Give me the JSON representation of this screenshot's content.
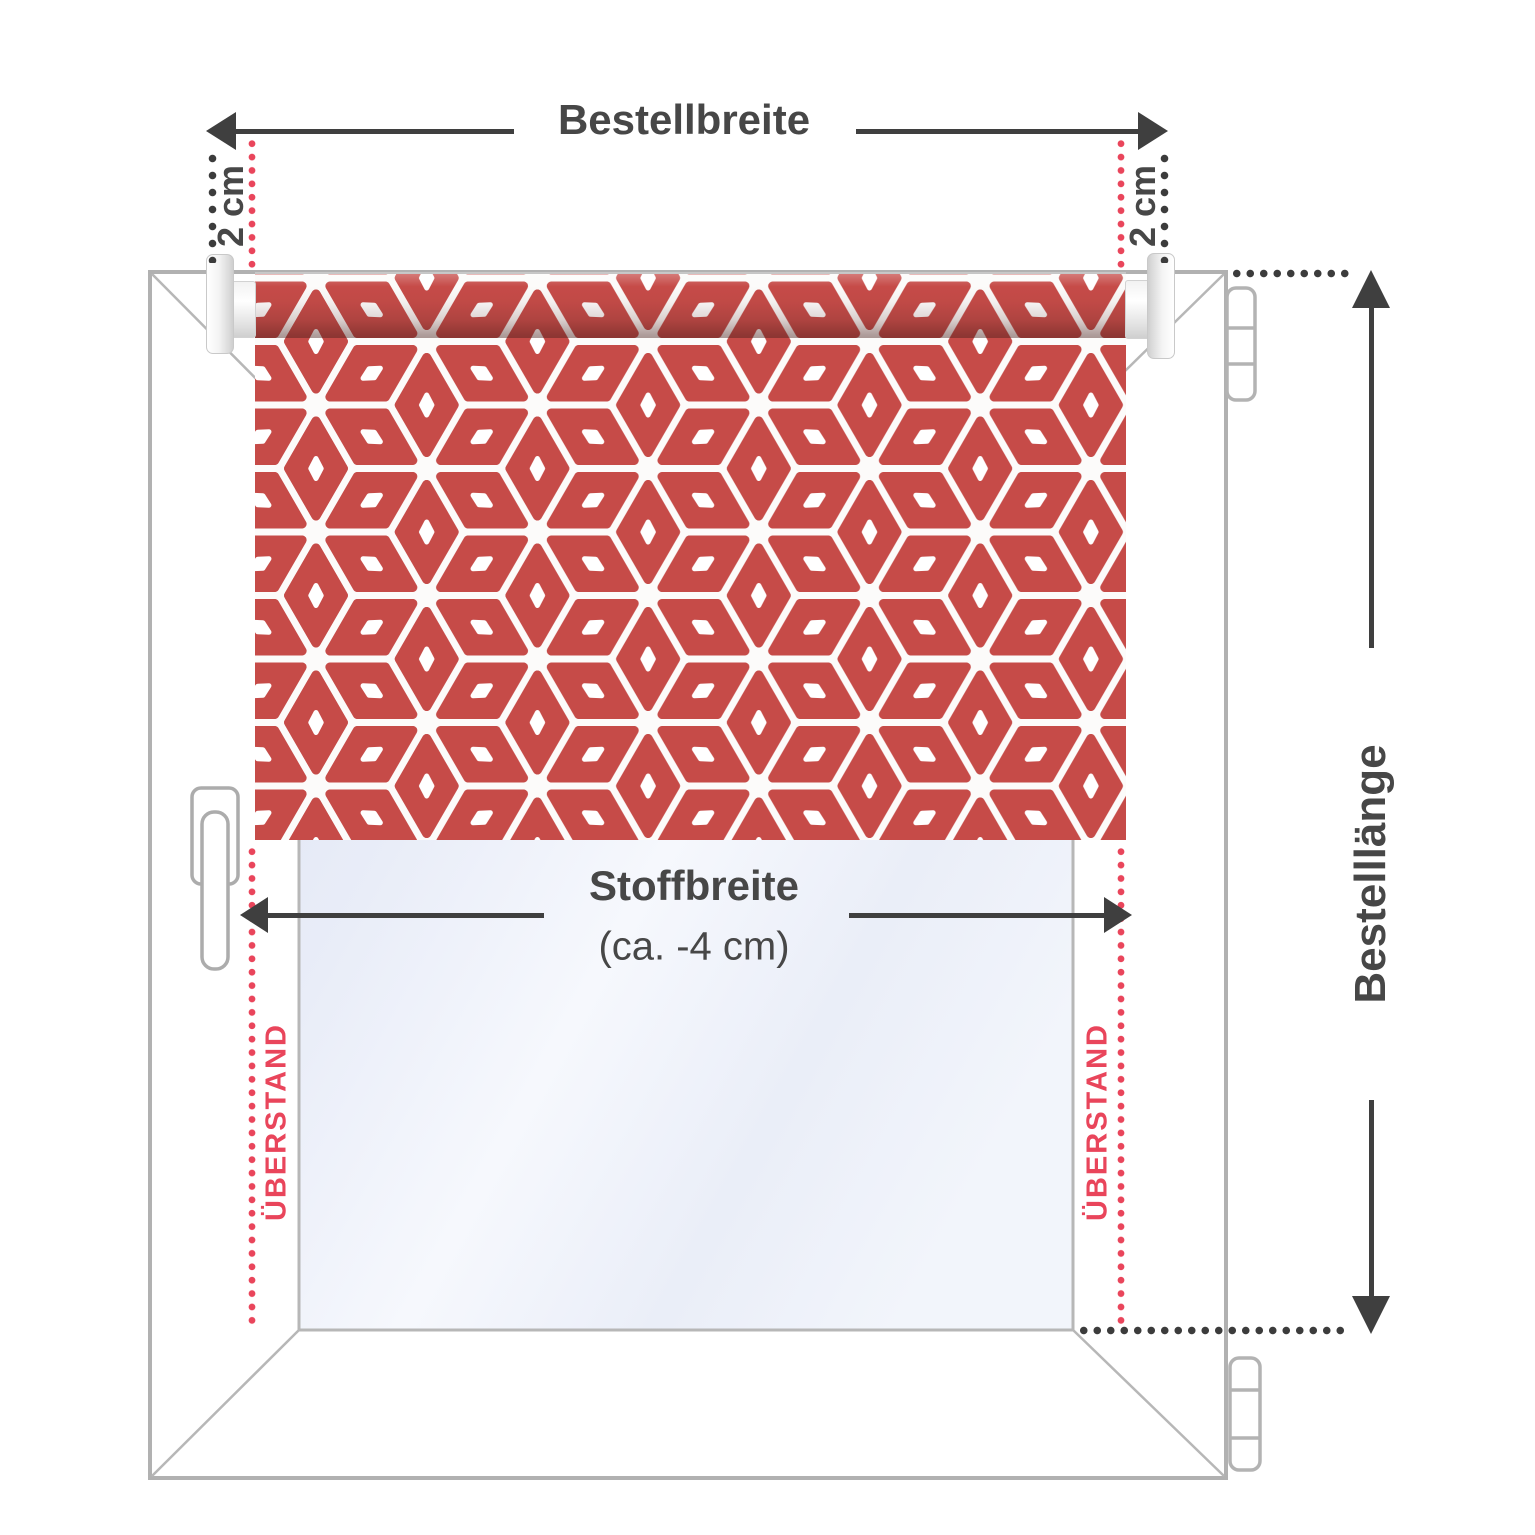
{
  "labels": {
    "order_width": "Bestellbreite",
    "offset_left": "2 cm",
    "offset_right": "2 cm",
    "fabric_width": "Stoffbreite",
    "fabric_width_note": "(ca. -4 cm)",
    "overhang_left": "ÜBERSTAND",
    "overhang_right": "ÜBERSTAND",
    "order_length": "Bestelllänge"
  },
  "colors": {
    "arrow_dark": "#3f3f3f",
    "text_dark": "#474747",
    "dot_dark": "#3c3c3c",
    "accent_red": "#e9455b",
    "fabric_red": "#c64b48",
    "frame_gray": "#b1b1b1",
    "frame_light": "#b7b7b7"
  },
  "icons": {
    "window": "window-frame",
    "glass": "glass-pane",
    "handle": "window-handle",
    "hinge_top": "hinge",
    "hinge_bottom": "hinge",
    "blind": "roller-blind-fabric",
    "bracket_left": "roller-bracket",
    "bracket_right": "roller-bracket"
  }
}
